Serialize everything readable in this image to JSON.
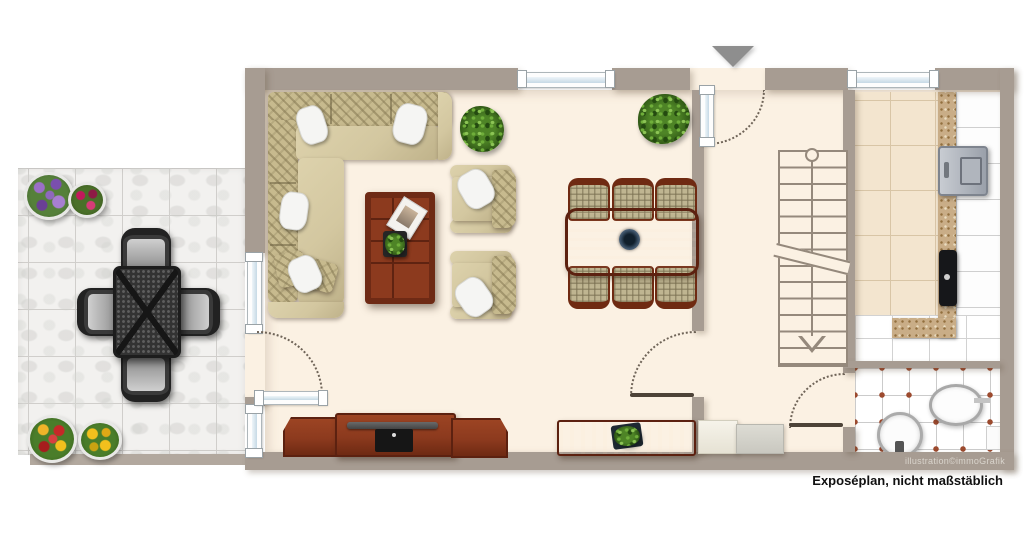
{
  "footer": {
    "credit": "illustration©immoGrafik",
    "disclaimer": "Exposéplan, nicht maßstäblich"
  },
  "colors": {
    "wall": "#a79c92",
    "wallstrip": "#b2a89e",
    "floor": "#fbf1e3",
    "terracetile": "#f2f1ef",
    "terracegrout": "#d0cecb",
    "kitchentile": "#f3e5cf",
    "kitchengrout": "#d8c5a6",
    "counter": "#c9ad87",
    "bathdot": "#9c4a2e",
    "glass": "#c6d9e5",
    "stair": "#95897c",
    "arc": "#6f6458",
    "arcleaf": "#4d4338",
    "wood": "#8c3a1e",
    "wooddark": "#5c2110",
    "sofa": "#d3c7a0",
    "cushion": "#c7ba8e",
    "pillow": "#f5f5f3",
    "arrow": "#8e8e8e",
    "textlight": "#d9d4cc",
    "textdark": "#111111"
  },
  "icons": {
    "entrance-arrow": "triangle-down",
    "stair-direction-arrow": "triangle-down-outline",
    "door-swing": "dotted-quarter-arc"
  },
  "rooms": [
    "terrace",
    "living-room",
    "dining-area",
    "entrance-hall",
    "staircase",
    "kitchen",
    "bathroom"
  ]
}
